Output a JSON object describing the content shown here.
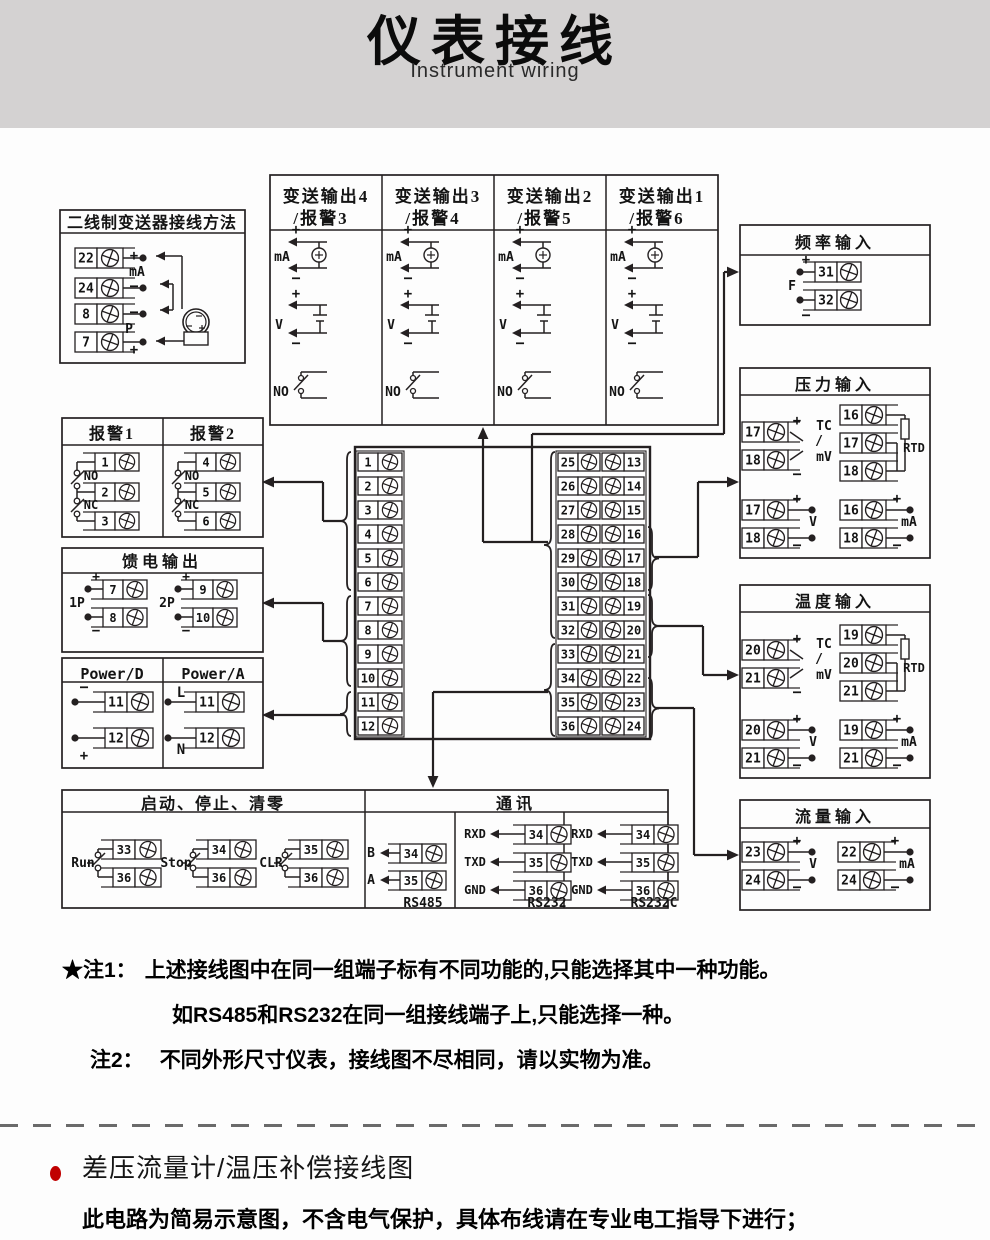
{
  "header": {
    "title": "仪表接线",
    "subtitle": "Instrument wiring"
  },
  "colors": {
    "banner_bg": "#d4d2d2",
    "line": "#242021",
    "accent_red": "#c00000"
  },
  "sym": {
    "plus": "+",
    "minus": "−",
    "mA": "mA",
    "V": "V",
    "NO": "NO",
    "NC": "NC",
    "F": "F",
    "P": "P",
    "TC": "TC",
    "slash": "/",
    "mV": "mV",
    "RTD": "RTD",
    "L": "L",
    "N": "N"
  },
  "two_wire": {
    "title": "二线制变送器接线方法",
    "t": [
      "22",
      "24",
      "8",
      "7"
    ]
  },
  "transmit": {
    "cols": [
      {
        "l1": "变送输出4",
        "l2": "/报警3",
        "a": "25",
        "b": "26"
      },
      {
        "l1": "变送输出3",
        "l2": "/报警4",
        "a": "27",
        "b": "28"
      },
      {
        "l1": "变送输出2",
        "l2": "/报警5",
        "a": "29",
        "b": "30"
      },
      {
        "l1": "变送输出1",
        "l2": "/报警6",
        "a": "31",
        "b": "32"
      }
    ]
  },
  "freq": {
    "title": "频率输入",
    "a": "31",
    "b": "32"
  },
  "alarm": {
    "t1": "报警1",
    "t2": "报警2",
    "c1": [
      "1",
      "2",
      "3"
    ],
    "c2": [
      "4",
      "5",
      "6"
    ]
  },
  "feed": {
    "title": "馈电输出",
    "g1": "1P",
    "g2": "2P",
    "t": [
      "7",
      "8",
      "9",
      "10"
    ]
  },
  "power": {
    "t1": "Power/D",
    "t2": "Power/A",
    "a": "11",
    "b": "12"
  },
  "control": {
    "title": "启动、停止、清零",
    "g": [
      {
        "l": "Run",
        "a": "33",
        "b": "36"
      },
      {
        "l": "Stop",
        "a": "34",
        "b": "36"
      },
      {
        "l": "CLR",
        "a": "35",
        "b": "36"
      }
    ]
  },
  "comm": {
    "title": "通讯",
    "rs485": {
      "name": "RS485",
      "rows": [
        {
          "s": "B",
          "t": "34"
        },
        {
          "s": "A",
          "t": "35"
        }
      ]
    },
    "rs232": {
      "name": "RS232",
      "rows": [
        {
          "s": "RXD",
          "t": "34"
        },
        {
          "s": "TXD",
          "t": "35"
        },
        {
          "s": "GND",
          "t": "36"
        }
      ]
    },
    "rs232c": {
      "name": "RS232C",
      "rows": [
        {
          "s": "RXD",
          "t": "34"
        },
        {
          "s": "TXD",
          "t": "35"
        },
        {
          "s": "GND",
          "t": "36"
        }
      ]
    }
  },
  "pressure": {
    "title": "压力输入",
    "tc": [
      "17",
      "18"
    ],
    "rtd": [
      "16",
      "17",
      "18"
    ],
    "v": [
      "17",
      "18"
    ],
    "ma": [
      "16",
      "18"
    ]
  },
  "temp": {
    "title": "温度输入",
    "tc": [
      "20",
      "21"
    ],
    "rtd": [
      "19",
      "20",
      "21"
    ],
    "v": [
      "20",
      "21"
    ],
    "ma": [
      "19",
      "21"
    ]
  },
  "flow": {
    "title": "流量输入",
    "v": [
      "23",
      "24"
    ],
    "ma": [
      "22",
      "24"
    ]
  },
  "center": {
    "left": [
      "1",
      "2",
      "3",
      "4",
      "5",
      "6",
      "7",
      "8",
      "9",
      "10",
      "11",
      "12"
    ],
    "mid": [
      "25",
      "26",
      "27",
      "28",
      "29",
      "30",
      "31",
      "32",
      "33",
      "34",
      "35",
      "36"
    ],
    "right": [
      "13",
      "14",
      "15",
      "16",
      "17",
      "18",
      "19",
      "20",
      "21",
      "22",
      "23",
      "24"
    ]
  },
  "notes": {
    "n1_label": "★注1：",
    "n1_text": "上述接线图中在同一组端子标有不同功能的,只能选择其中一种功能。",
    "n1_line2": "如RS485和RS232在同一组接线端子上,只能选择一种。",
    "n2_label": "注2：",
    "n2_text": "不同外形尺寸仪表，接线图不尽相同，请以实物为准。"
  },
  "bottom": {
    "heading": "差压流量计/温压补偿接线图",
    "body": "此电路为简易示意图，不含电气保护，具体布线请在专业电工指导下进行；"
  }
}
